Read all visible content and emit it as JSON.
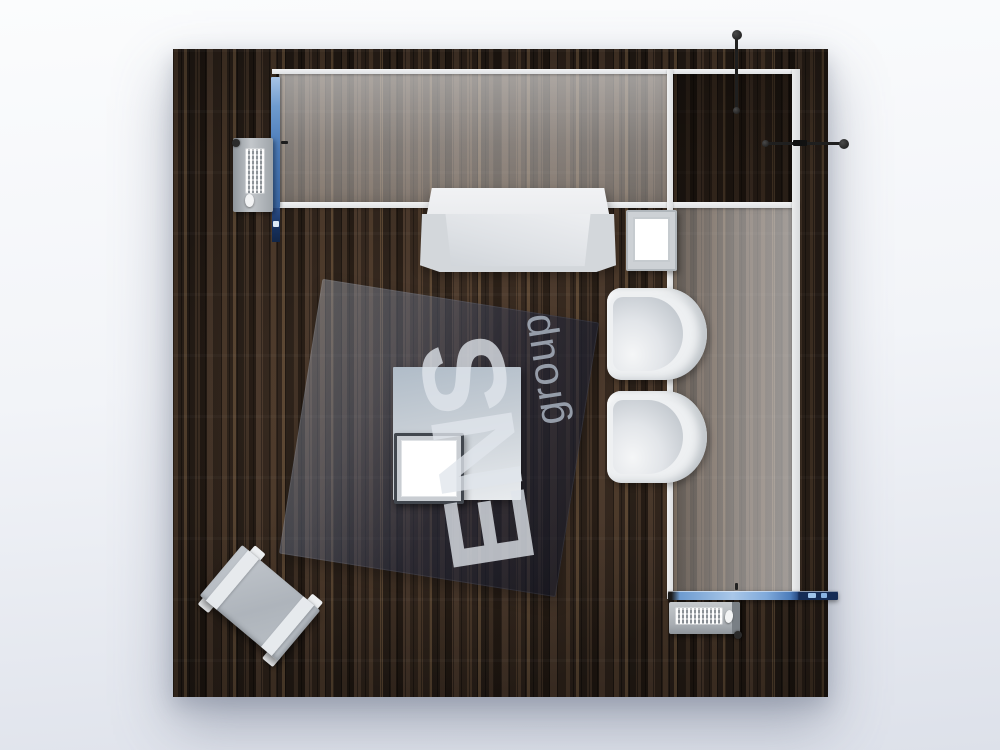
{
  "scene": {
    "watermark": {
      "brand": "ENS",
      "suffix": "group"
    },
    "colors": {
      "background_top": "#fbfcfd",
      "background_bottom": "#dde1ea",
      "floor_wood_dark": "#221a14",
      "floor_wood_mid": "#3a2c21",
      "accent_blue_light": "#a9c7e8",
      "accent_blue": "#4c7cba",
      "accent_navy": "#152c55",
      "glass_frame_white": "#eceded",
      "glass_tint": "#ded9d5",
      "furniture_white": "#eef0f2",
      "furniture_gray": "#b6bdc4",
      "spotlight_black": "#1f1f1f",
      "watermark_text": "#e0e5ec"
    },
    "objects": [
      {
        "name": "wood-floor-platform"
      },
      {
        "name": "glass-wall-top"
      },
      {
        "name": "glass-wall-right"
      },
      {
        "name": "storage-room"
      },
      {
        "name": "led-strip-left"
      },
      {
        "name": "led-bar-bottom"
      },
      {
        "name": "reception-counter"
      },
      {
        "name": "wall-cube-table"
      },
      {
        "name": "lounge-chair-upper"
      },
      {
        "name": "lounge-chair-lower"
      },
      {
        "name": "dark-display-mat"
      },
      {
        "name": "center-table"
      },
      {
        "name": "center-cube-seat"
      },
      {
        "name": "coffee-bench"
      },
      {
        "name": "workstation-left"
      },
      {
        "name": "workstation-bottom"
      },
      {
        "name": "spotlight-top"
      },
      {
        "name": "spotlight-right"
      }
    ]
  }
}
